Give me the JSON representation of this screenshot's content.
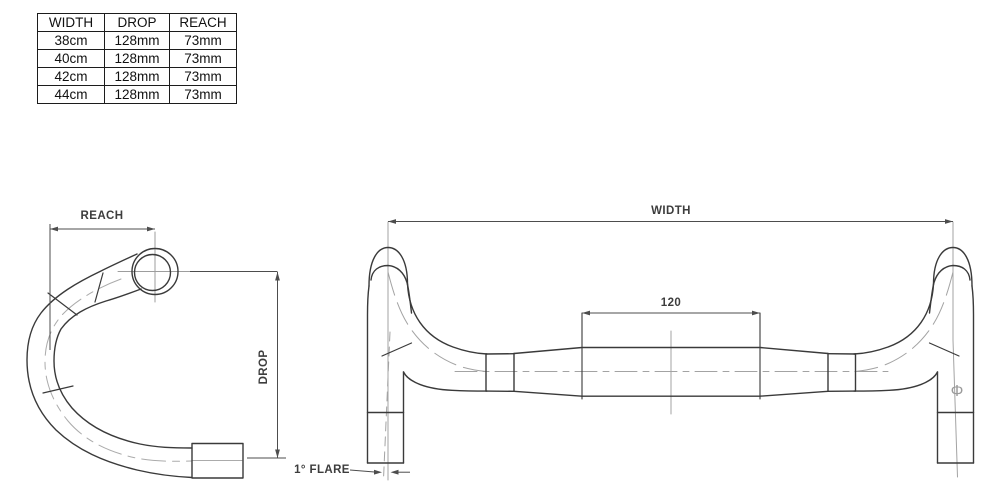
{
  "spec_table": {
    "headers": [
      "WIDTH",
      "DROP",
      "REACH"
    ],
    "rows": [
      [
        "38cm",
        "128mm",
        "73mm"
      ],
      [
        "40cm",
        "128mm",
        "73mm"
      ],
      [
        "42cm",
        "128mm",
        "73mm"
      ],
      [
        "44cm",
        "128mm",
        "73mm"
      ]
    ]
  },
  "side_view": {
    "reach_label": "REACH",
    "drop_label": "DROP"
  },
  "front_view": {
    "width_label": "WIDTH",
    "clamp_width_label": "120",
    "flare_label": "1° FLARE",
    "diameter_symbol": "Φ"
  },
  "colors": {
    "outline": "#3a3a3a",
    "dimension": "#4d4d4d",
    "centerline": "#a3a3a3"
  }
}
